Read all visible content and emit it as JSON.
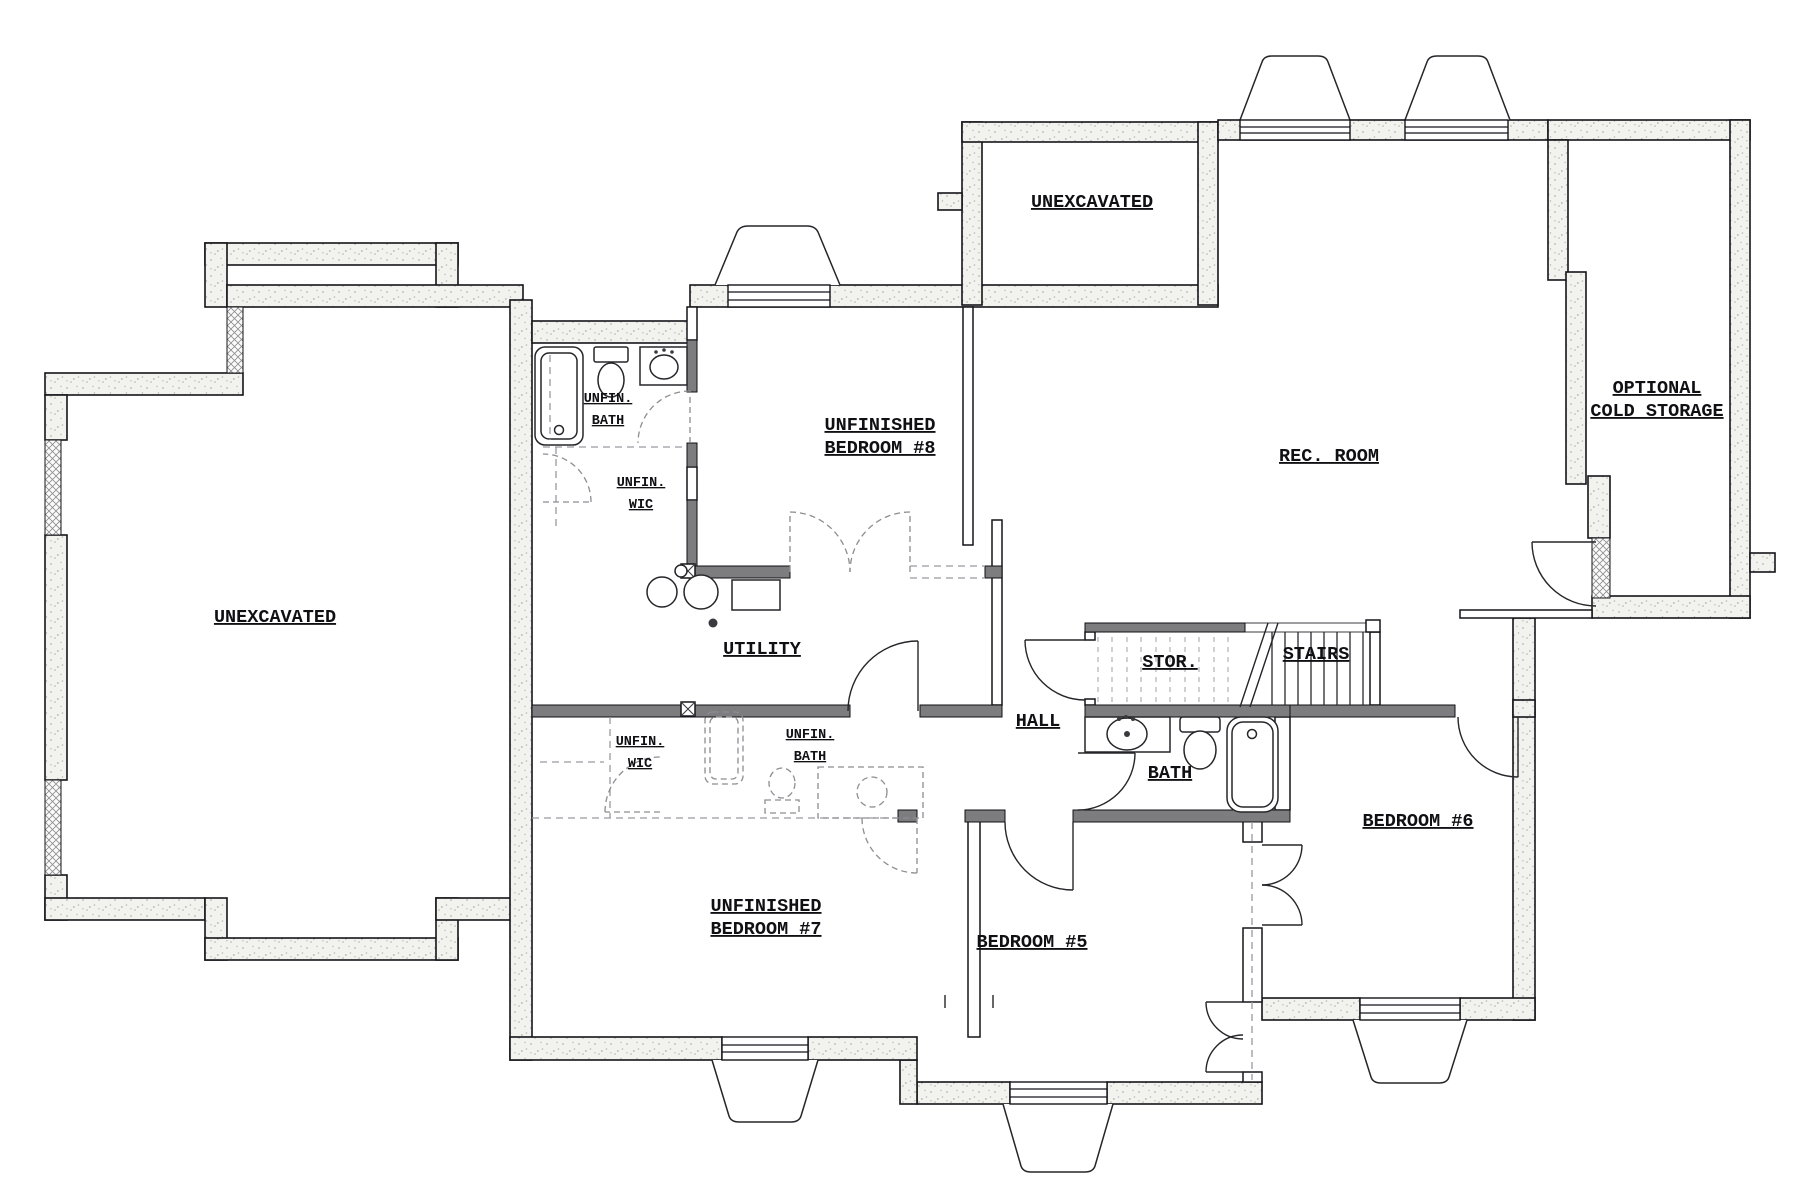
{
  "plan": {
    "type": "basement-floor-plan",
    "colors": {
      "wall_stipple_bg": "#f2f2ef",
      "wall_poche": "#7d7d80",
      "line": "#15151a",
      "unfinished_dash": "#9a9aa0"
    },
    "rooms": {
      "unexcavated_left": {
        "label": "UNEXCAVATED"
      },
      "unexcavated_upper": {
        "label": "UNEXCAVATED"
      },
      "rec_room": {
        "label": "REC. ROOM"
      },
      "cold_storage": {
        "line1": "OPTIONAL",
        "line2": "COLD STORAGE"
      },
      "bedroom8": {
        "line1": "UNFINISHED",
        "line2": "BEDROOM #8"
      },
      "unfin_bath_upper": {
        "line1": "UNFIN.",
        "line2": "BATH"
      },
      "unfin_wic_upper": {
        "line1": "UNFIN.",
        "line2": "WIC"
      },
      "utility": {
        "label": "UTILITY"
      },
      "hall": {
        "label": "HALL"
      },
      "stor": {
        "label": "STOR."
      },
      "stairs": {
        "label": "STAIRS"
      },
      "bath": {
        "label": "BATH"
      },
      "bedroom6": {
        "label": "BEDROOM #6"
      },
      "unfin_wic_lower": {
        "line1": "UNFIN.",
        "line2": "WIC"
      },
      "unfin_bath_lower": {
        "line1": "UNFIN.",
        "line2": "BATH"
      },
      "bedroom7": {
        "line1": "UNFINISHED",
        "line2": "BEDROOM #7"
      },
      "bedroom5": {
        "label": "BEDROOM #5"
      }
    }
  }
}
